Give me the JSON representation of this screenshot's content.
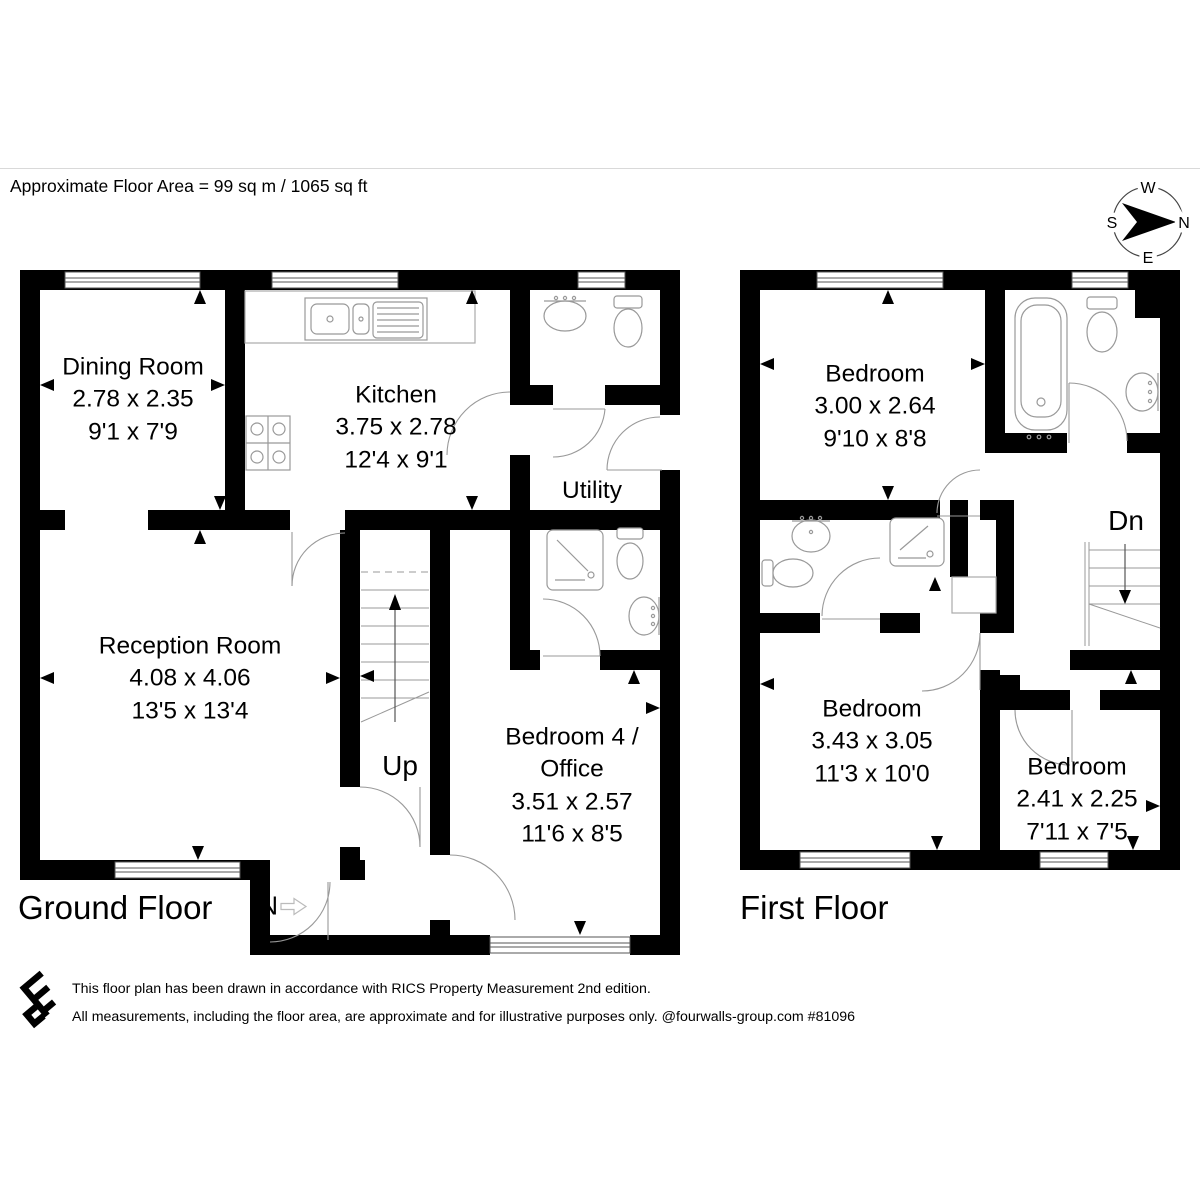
{
  "header": {
    "floor_area_label": "Approximate Floor Area = 99 sq m / 1065 sq ft"
  },
  "compass": {
    "north": "N",
    "south": "S",
    "east": "E",
    "west": "W"
  },
  "ground_floor": {
    "title": "Ground Floor",
    "stairs_label": "Up",
    "entrance_label": "IN",
    "rooms": {
      "dining_room": {
        "name": "Dining Room",
        "metric": "2.78 x 2.35",
        "imperial": "9'1 x 7'9"
      },
      "kitchen": {
        "name": "Kitchen",
        "metric": "3.75 x 2.78",
        "imperial": "12'4 x 9'1"
      },
      "utility": {
        "name": "Utility"
      },
      "reception_room": {
        "name": "Reception Room",
        "metric": "4.08 x 4.06",
        "imperial": "13'5 x 13'4"
      },
      "bedroom4_office": {
        "name_line1": "Bedroom 4 /",
        "name_line2": "Office",
        "metric": "3.51 x 2.57",
        "imperial": "11'6 x 8'5"
      }
    }
  },
  "first_floor": {
    "title": "First Floor",
    "stairs_label": "Dn",
    "rooms": {
      "bedroom_1": {
        "name": "Bedroom",
        "metric": "3.00 x 2.64",
        "imperial": "9'10 x 8'8"
      },
      "bedroom_2": {
        "name": "Bedroom",
        "metric": "3.43 x 3.05",
        "imperial": "11'3 x 10'0"
      },
      "bedroom_3": {
        "name": "Bedroom",
        "metric": "2.41 x 2.25",
        "imperial": "7'11 x 7'5"
      }
    }
  },
  "footer": {
    "line1": "This floor plan has been drawn in accordance with RICS Property Measurement 2nd edition.",
    "line2": "All measurements, including the floor area, are approximate and for illustrative purposes only. @fourwalls-group.com #81096"
  },
  "colors": {
    "wall": "#000000",
    "fixture_line": "#999999",
    "door_line": "#999999",
    "text": "#000000"
  }
}
